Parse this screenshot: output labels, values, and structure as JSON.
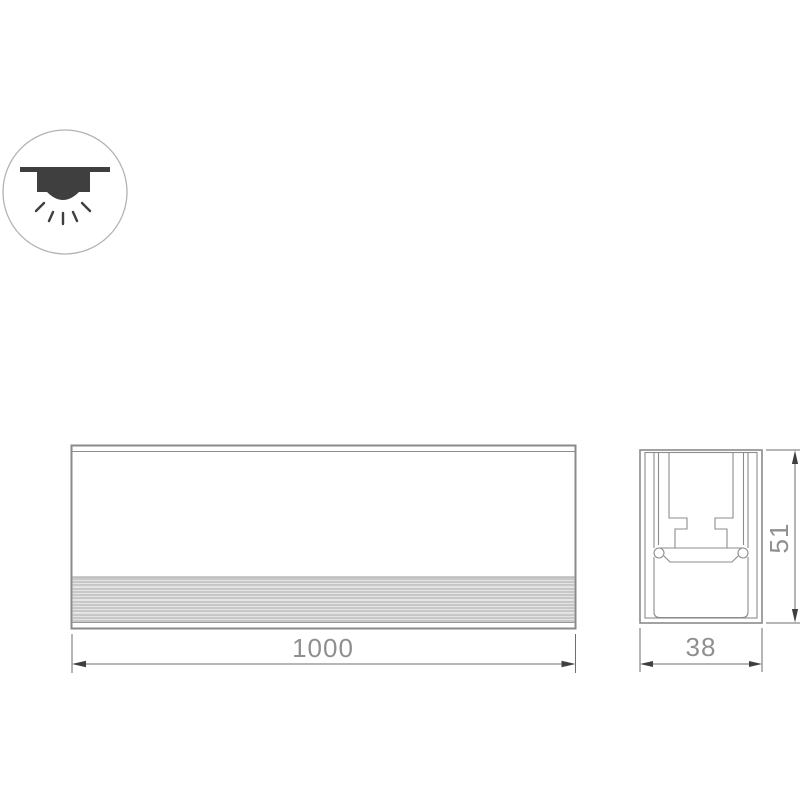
{
  "drawing": {
    "icon": {
      "name": "recessed-downlight",
      "style": "circle-outline"
    },
    "views": {
      "front": {
        "length_label": "1000"
      },
      "section": {
        "width_label": "38",
        "height_label": "51"
      }
    },
    "colors": {
      "outline": "#8a8a8a",
      "detail_line": "#8c8c8c",
      "dim_line": "#6e6e6e",
      "arrow": "#3f3f3f",
      "dim_text": "#8f8f8f",
      "icon_symbol": "#3f3f3f",
      "icon_circle": "#b3b3b3",
      "stripe_fill": "#e4e4e4",
      "stripe_line": "#ababab",
      "background": "#ffffff"
    }
  }
}
